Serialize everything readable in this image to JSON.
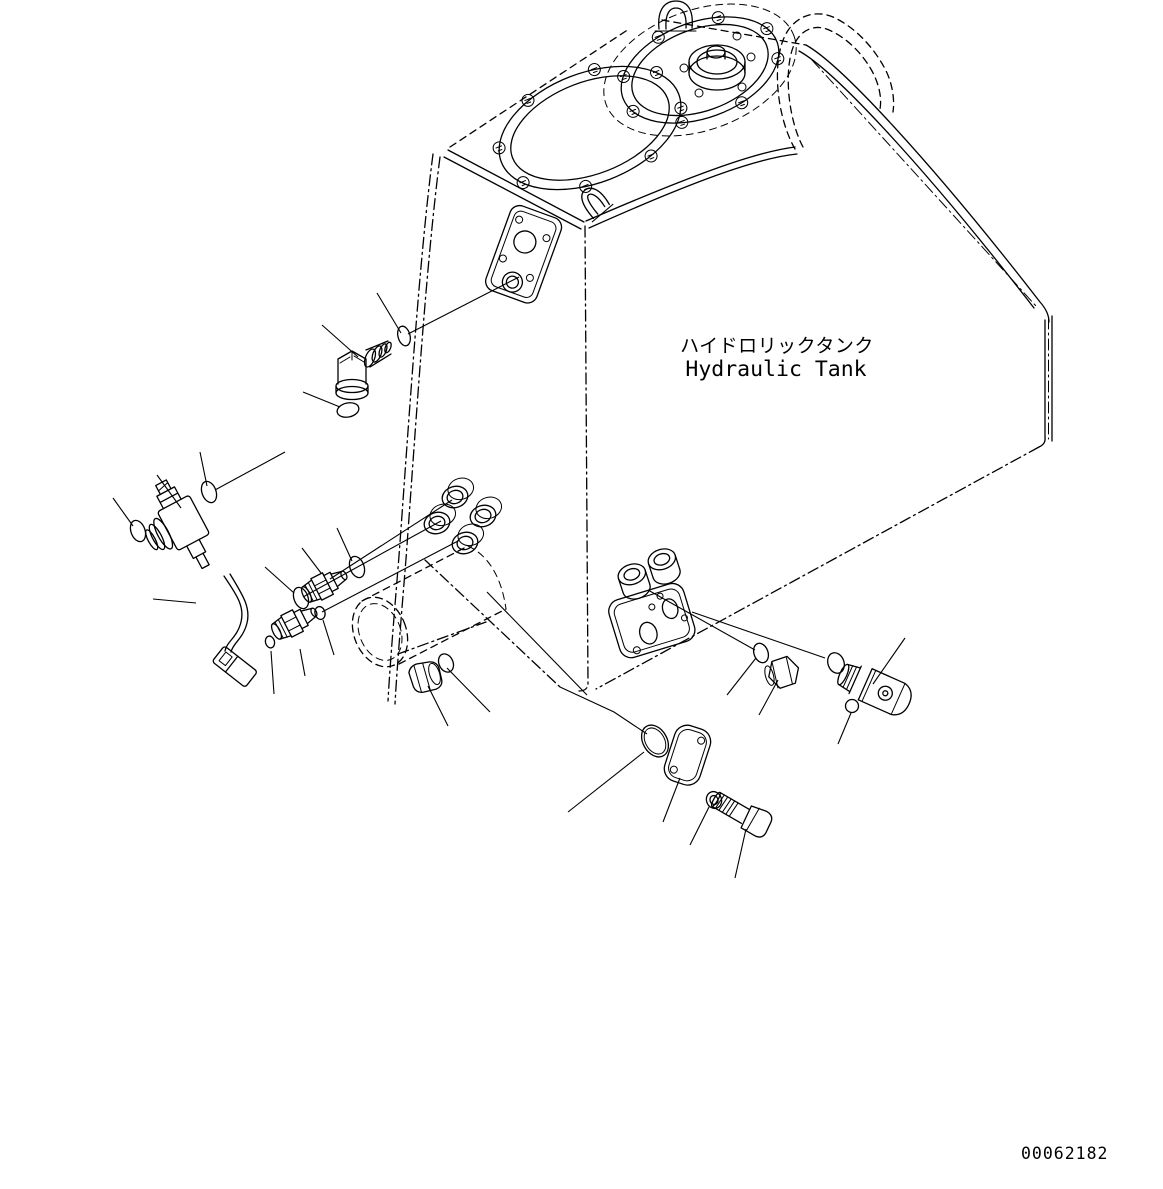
{
  "page": {
    "background_color": "#ffffff",
    "line_color": "#000000"
  },
  "labels": {
    "tank_title_ja": "ハイドロリックタンク",
    "tank_title_en": "Hydraulic Tank",
    "drawing_number": "00062182"
  },
  "diagram": {
    "type": "exploded-parts-diagram",
    "subject": "hydraulic-tank",
    "parts": [
      "hydraulic-tank-body",
      "filler-cover-left",
      "filler-cover-right",
      "breather-cap",
      "lifting-eye-top",
      "lifting-eye-front",
      "handrail",
      "left-handrail-tube",
      "front-mounting-pad",
      "port-boss",
      "suction-strainer",
      "manifold-block",
      "elbow-fitting",
      "pressure-sensor",
      "sensor-cable",
      "cable-connector",
      "nipple-fitting",
      "o-ring",
      "gasket",
      "plug",
      "hex-plug",
      "shutoff-valve",
      "cover-plate",
      "washer",
      "bolt"
    ]
  }
}
